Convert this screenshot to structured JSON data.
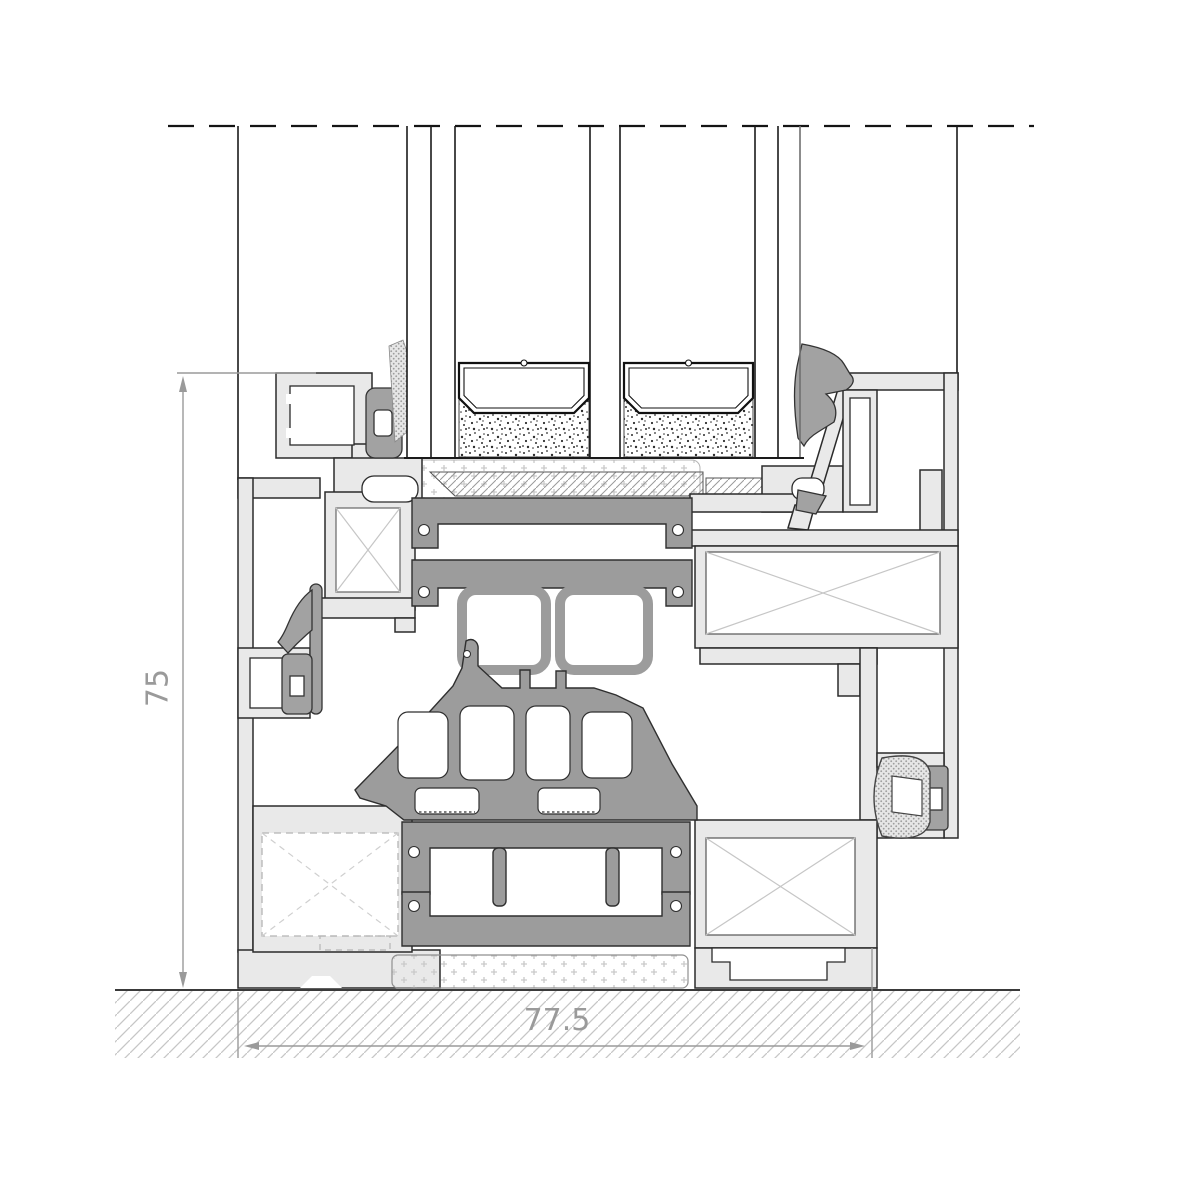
{
  "drawing": {
    "dimensions": {
      "height_label": "75",
      "width_label": "77.5"
    },
    "colors": {
      "aluminum": "#e9e9e9",
      "thermal_break": "#9c9c9c",
      "gasket": "#a2a2a2",
      "outline": "#2b2b2b",
      "dimension_gray": "#9a9a9a",
      "hatch_gray": "#c6c6c6",
      "background": "#ffffff"
    },
    "legend": {
      "section_parts": [
        "break-line",
        "glazing-unit",
        "glazing-spacer-bars",
        "edge-sealant",
        "outer-frame",
        "sash",
        "thermal-break-bars",
        "glazing-bridge",
        "gaskets",
        "screw-ports",
        "setting-block",
        "perimeter-foam",
        "ground-hatch"
      ]
    }
  }
}
